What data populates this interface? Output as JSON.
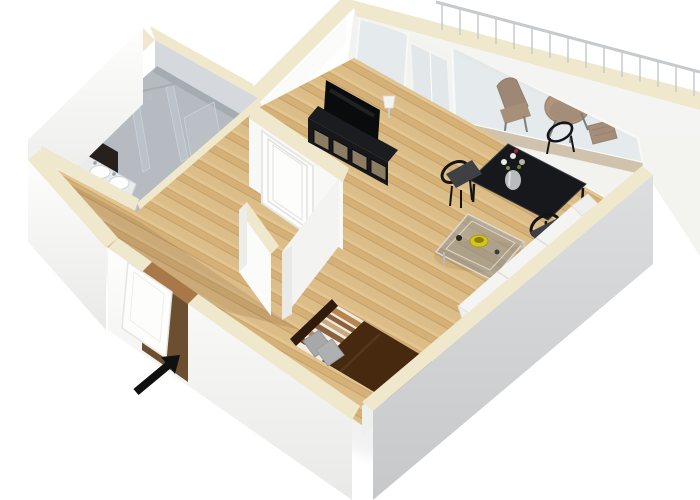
{
  "scene": {
    "type": "3d-floor-plan-render",
    "view": "isometric-3d",
    "description": "3D isometric rendering of a studio apartment floor plan with white walls, cream wall tops, wood flooring and furnished rooms",
    "rooms": [
      {
        "id": "bathroom",
        "label": "Bathroom",
        "floor": "grey tile",
        "features": [
          "double-sink vanity",
          "dark accent panel",
          "walk-in glass shower",
          "wc door opening with toilet"
        ]
      },
      {
        "id": "hallway",
        "label": "Entrance hall",
        "floor": "wood",
        "features": [
          "open entrance door",
          "white panel door to living room",
          "partition stub wall"
        ]
      },
      {
        "id": "living-room",
        "label": "Living / dining room",
        "floor": "light oak wood",
        "features": [
          "black tv sideboard with tv and table lamp",
          "black dining table with flower vase and three chairs",
          "smoked-glass coffee table with yellow bowl",
          "white sofa along wall"
        ]
      },
      {
        "id": "sleeping-area",
        "label": "Sleeping area",
        "floor": "light oak wood",
        "features": [
          "double bed with striped bedding, dark brown runner and grey pillows"
        ]
      },
      {
        "id": "balcony",
        "label": "Balcony",
        "floor": "light concrete",
        "features": [
          "metal railing",
          "round wooden bistro table",
          "two brown chairs"
        ]
      }
    ],
    "entrance_marker": {
      "type": "arrow",
      "points_to": "entrance-door",
      "direction": "up-right"
    }
  },
  "colors": {
    "page_bg": "#ffffff",
    "wall_top": "#efe8cd",
    "wall_white": "#fbfbf9",
    "wall_face_light": "#f6f6f4",
    "bath_wall": "#d5d9dd",
    "bath_floor": "#b6bbc1",
    "wood_base": "#ddbd87",
    "wood_dark": "#a87848",
    "glass": "rgba(206,218,224,0.42)",
    "sill": "#cfc3ae",
    "railing": "#c6cacc",
    "black_furniture": "#17181b",
    "tv_black": "#0a0b0d",
    "balcony_table_brown": "#9c6536",
    "chair_brown": "#7d4e28",
    "sofa": "#f4f4f2",
    "bed_blanket": "#46290f",
    "bed_headboard": "#2e1b0b",
    "pillow": "#a6a8aa",
    "bowl": "#d6c616",
    "door_white": "#fdfdfc",
    "dark_opening": "#1e1a17",
    "vanity_dark": "#27211d",
    "arrow": "#101010"
  }
}
